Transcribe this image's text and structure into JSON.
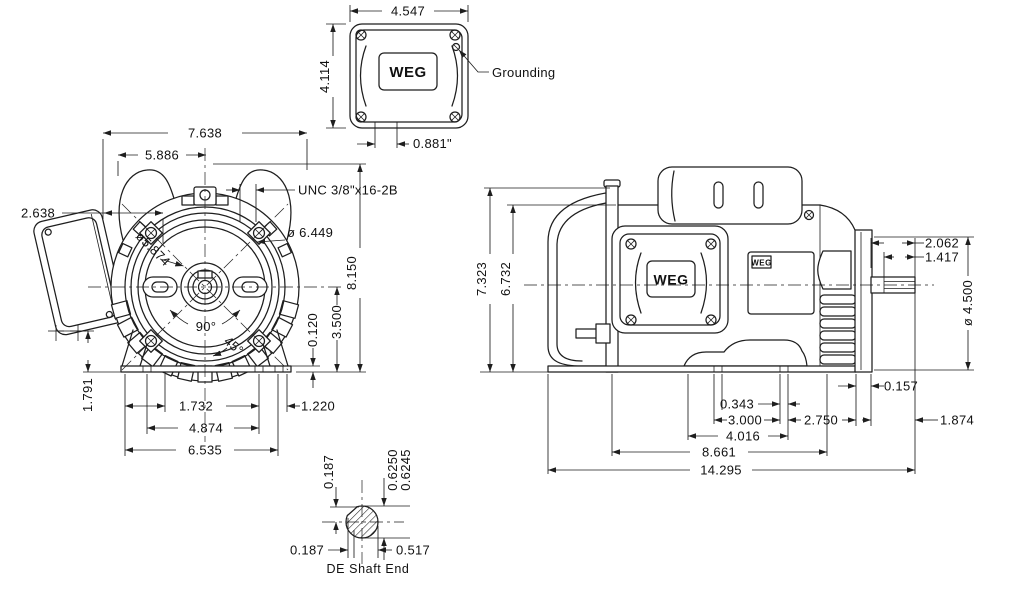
{
  "front_view": {
    "overall_width": "7.638",
    "lug_width": "5.886",
    "box_offset": "2.638",
    "thread_spec": "UNC 3/8\"x16-2B",
    "frame_dia": "ø 6.449",
    "inner_dia": "ø5.874",
    "overall_height": "8.150",
    "center_height": "3.500",
    "base_thickness": "0.120",
    "box_bottom_height": "1.791",
    "angle_90": "90°",
    "angle_45": "45°",
    "foot_slot_offset": "1.732",
    "foot_bolt_span": "4.874",
    "base_width": "6.535",
    "foot_edge_offset": "1.220"
  },
  "terminal_box_view": {
    "width": "4.547",
    "height": "4.114",
    "knockout": "0.881\"",
    "grounding_label": "Grounding",
    "logo": "WEG"
  },
  "side_view": {
    "overall_height": "7.323",
    "body_height": "6.732",
    "shaft_length": "2.062",
    "key_length": "1.417",
    "face_dia": "ø 4.500",
    "flange_gap": "0.157",
    "foot_slot_width": "0.343",
    "foot_hole_span": "3.000",
    "hole_to_face": "2.750",
    "foot_pad_length": "4.016",
    "base_length": "8.661",
    "overall_length": "14.295",
    "shaft_extension": "1.874",
    "logo": "WEG",
    "nameplate_logo": "WEG"
  },
  "shaft_detail": {
    "flat_depth": "0.187",
    "dia_max": "0.6250",
    "dia_min": "0.6245",
    "flat_offset": "0.187",
    "across_flat": "0.517",
    "label": "DE Shaft End"
  }
}
